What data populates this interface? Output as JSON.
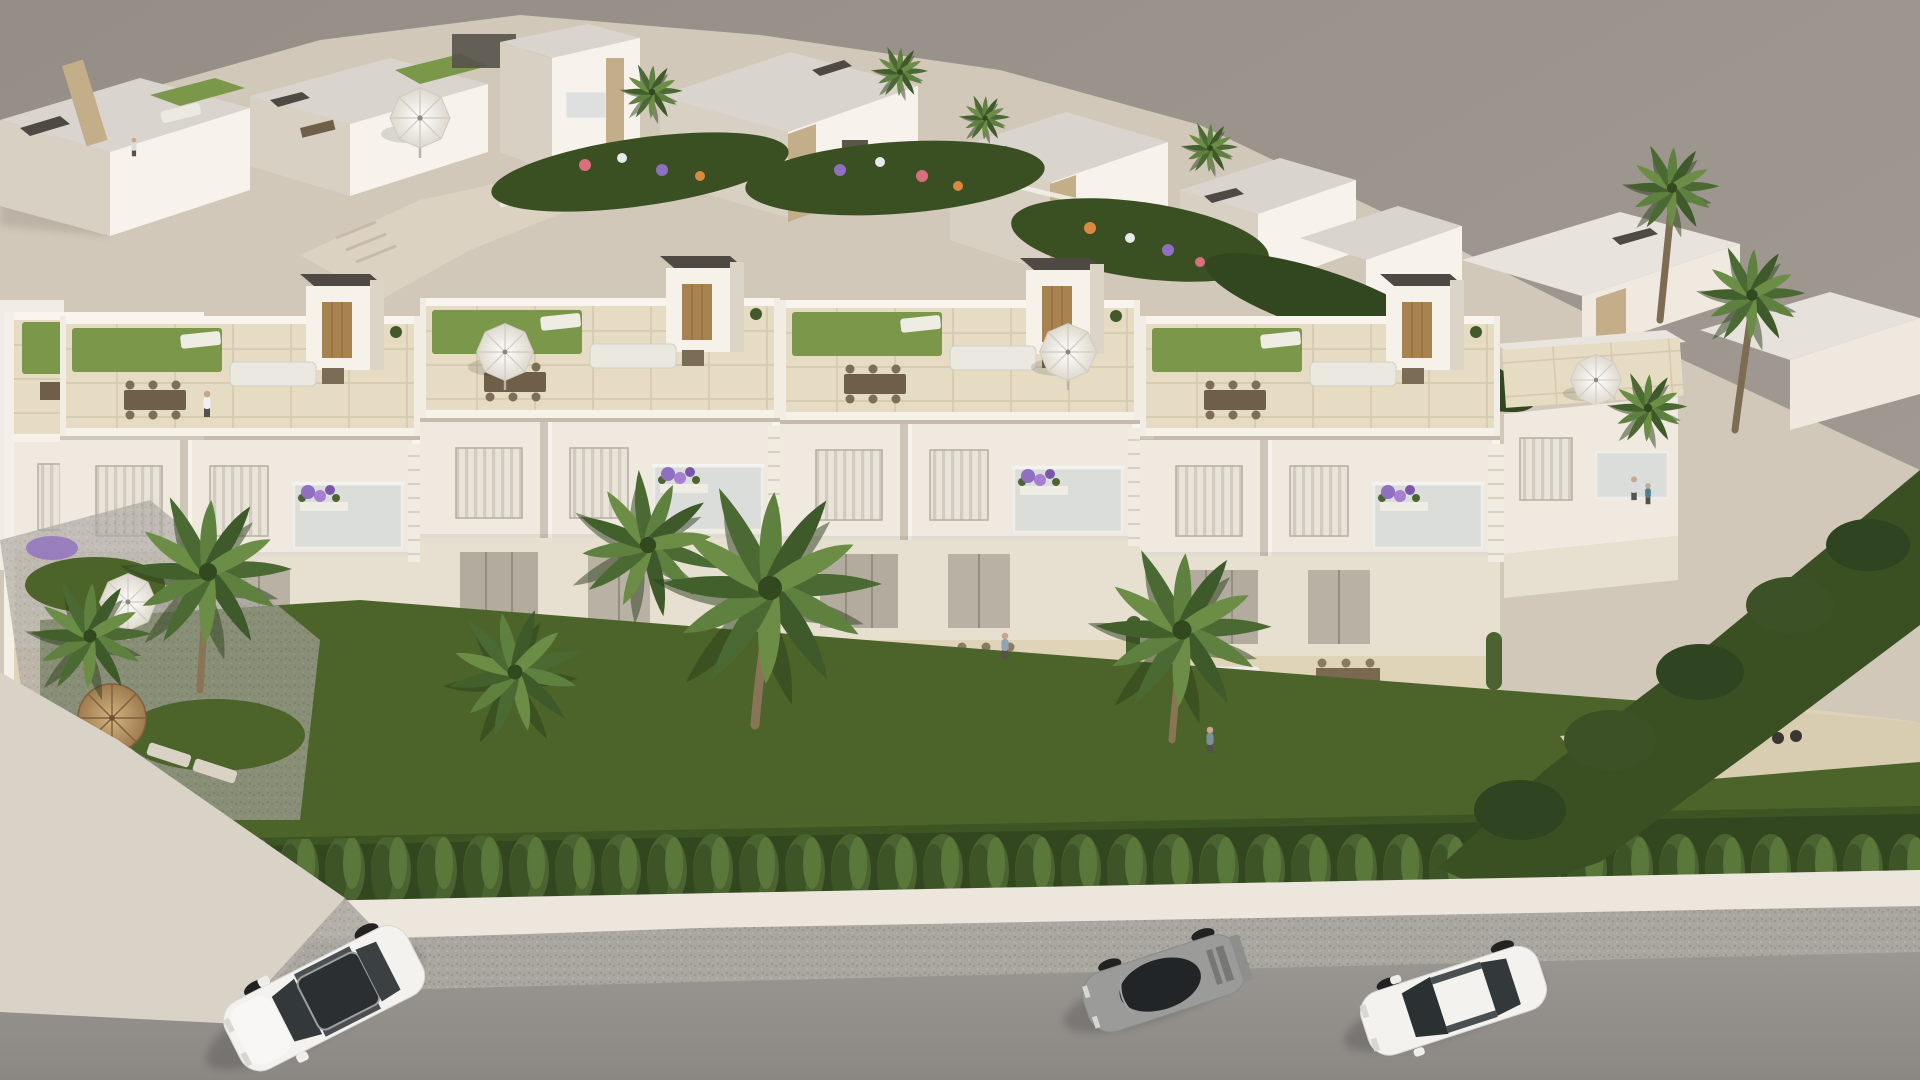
{
  "scene": {
    "type": "3D architectural exterior rendering (CGI)",
    "view": "high-angle aerial perspective, diagonal composition",
    "subject": "Modern white Mediterranean new-build residential development with rooftop solarium terraces",
    "lighting": "warm daylight, sun from upper right, soft shadows cast toward lower left",
    "background": "plain warm-gray studio backdrop, no rendered surroundings",
    "areas": {
      "back_row": "detached white villas with flat gray roofs, dark rooftop chimney boxes, tan stone accent walls, rooftop lawns and a pergola",
      "central_gardens": "communal gardens with flower beds, low white garden walls, pale walkways and palm trees",
      "main_block": "long terraced apartment building of four repeated units: rooftop terraces with porcelain tile and artificial lawn, stair bulkheads with wooden doors, white parasols, lounge and dining furniture; middle floor with shuttered windows and glass balconies holding purple flower planters; ground-floor patios with dining sets and daybeds",
      "frontage": "private lawns behind a continuous cypress hedge on a white perimeter street wall",
      "street": "white curb wall, gravel shoulder and asphalt road across the bottom edge, pale entrance apron at bottom left"
    },
    "vehicles": [
      {
        "type": "SUV",
        "color": "white",
        "detail": "dark panoramic glass roof",
        "position": "bottom left, angled down-left"
      },
      {
        "type": "sports coupe",
        "color": "gray",
        "position": "bottom center-right"
      },
      {
        "type": "sedan",
        "color": "white",
        "position": "bottom right"
      }
    ],
    "people": [
      {
        "where": "left rooftop terrace",
        "doing": "walking in white outfit"
      },
      {
        "where": "back villa roof terrace"
      },
      {
        "where": "central ground-floor patio"
      },
      {
        "where": "garden path on the right"
      },
      {
        "where": "right-wing balcony",
        "doing": "couple standing at the rail"
      }
    ],
    "vegetation": [
      "fan palm trees",
      "cypress hedge row",
      "bougainvillea and lavender planters",
      "mixed flower beds in purple, pink, orange and white",
      "straw-parasol garden corner at lower left"
    ],
    "furniture": [
      "white parasols",
      "straw parasol",
      "sun loungers",
      "outdoor corner sofas",
      "dining tables with chairs",
      "daybeds"
    ]
  },
  "palette": {
    "backdrop": "#9e978f",
    "site": "#d2c8b9",
    "roof_concrete": "#d9d5ce",
    "wall_light": "#efe9df",
    "wall_bright": "#f7f3ec",
    "wall_shade": "#d8d0c3",
    "wall_dark": "#c4bbac",
    "tile": "#e6dcc4",
    "tile_warm": "#dfd3b8",
    "lawn": "#7a974a",
    "lawn_dark": "#5e7c38",
    "garden": "#4c6329",
    "garden_dark": "#3a5022",
    "hedge": "#4a6330",
    "hedge_dark": "#32471f",
    "palm": "#54743a",
    "palm_dark": "#3b5527",
    "stone": "#c4ad89",
    "wood": "#a8834f",
    "roof_box": "#4e4a43",
    "road": "#93908c",
    "speckle": "#aaa6a0",
    "sidewalk": "#ece6dc",
    "apron": "#d9d2c7",
    "car_white": "#f3f2ef",
    "car_gray": "#9b9b99",
    "glass": "#2b2f31",
    "glass_tint": "#ccd4d6",
    "flower_purple": "#8f6fc0",
    "flower_pink": "#d8707f",
    "flower_orange": "#d98a3f",
    "flower_white": "#e8e9ea",
    "skin": "#caa58d"
  }
}
